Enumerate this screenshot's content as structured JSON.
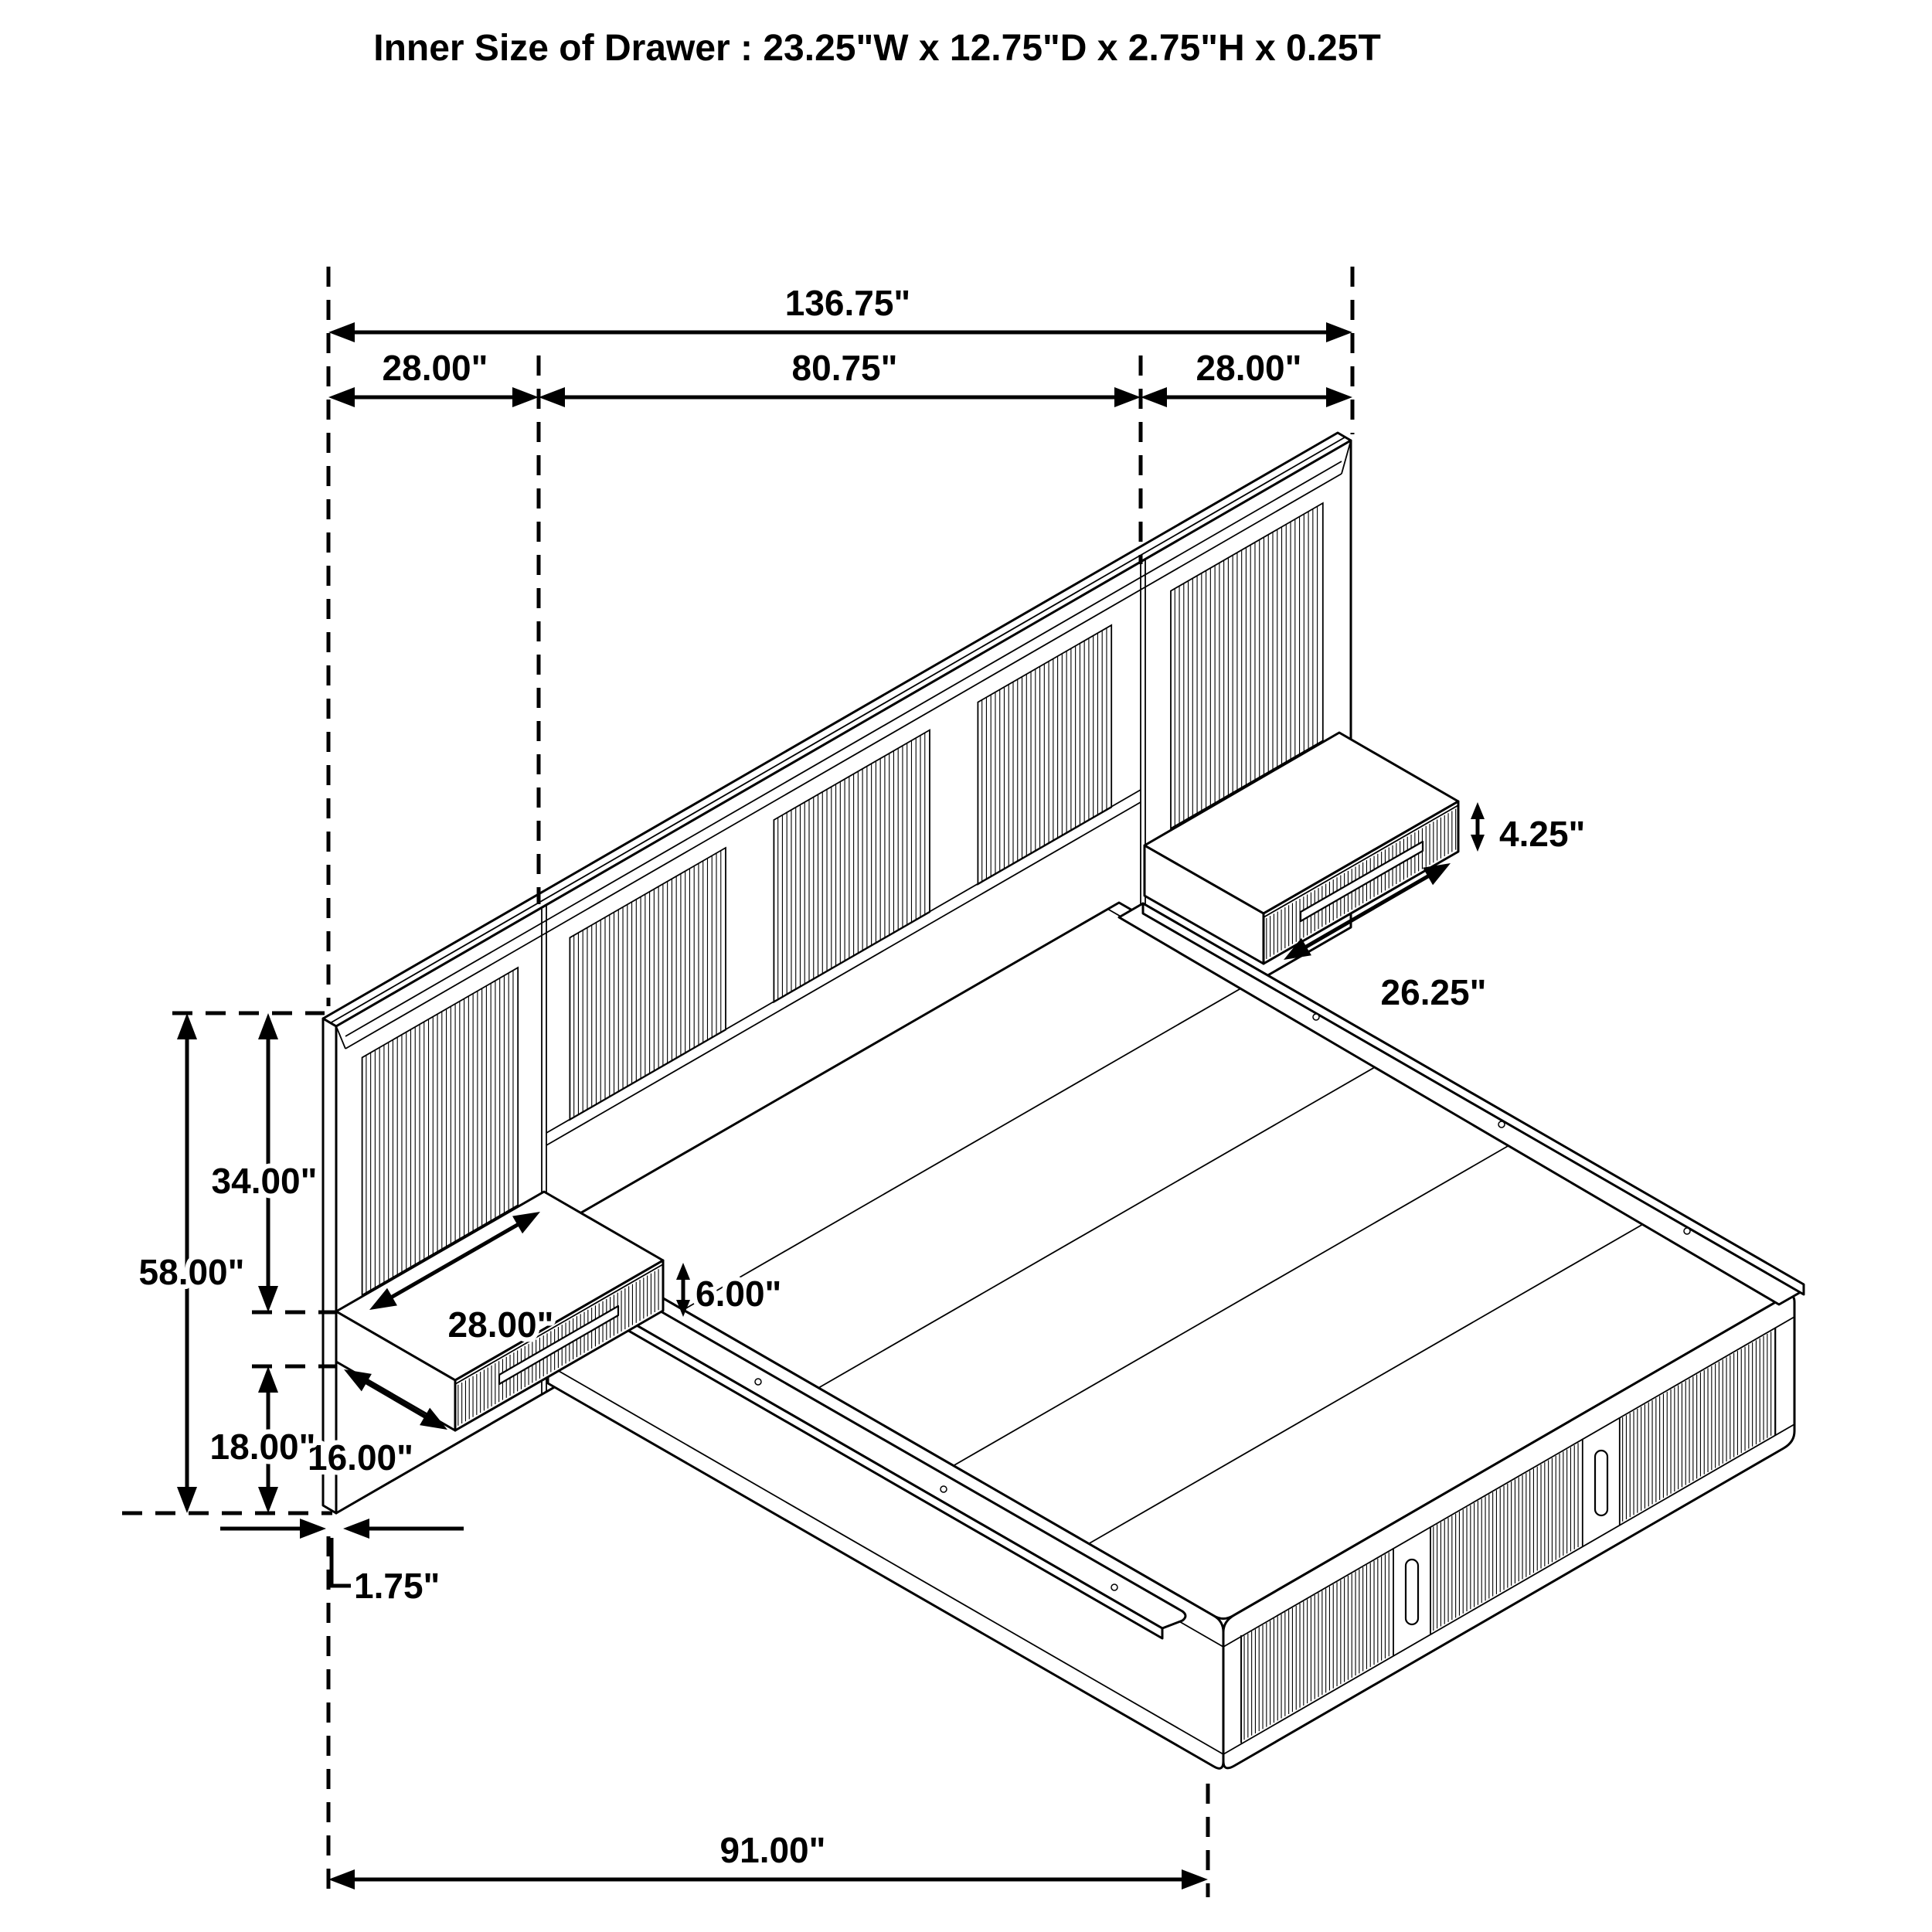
{
  "title": "Inner Size of Drawer : 23.25\"W x 12.75\"D x 2.75\"H x 0.25T",
  "colors": {
    "line": "#000000",
    "background": "#ffffff"
  },
  "labels": {
    "overall_width": "136.75\"",
    "left_section_width": "28.00\"",
    "middle_section_width": "80.75\"",
    "right_section_width": "28.00\"",
    "right_shelf_height": "4.25\"",
    "right_shelf_width": "26.25\"",
    "headboard_upper_height": "34.00\"",
    "headboard_total_height": "58.00\"",
    "left_shelf_depth": "16.00\"",
    "lower_height": "18.00\"",
    "panel_thickness": "1.75\"",
    "left_shelf_width": "28.00\"",
    "left_shelf_height": "6.00\"",
    "bed_length": "91.00\""
  }
}
